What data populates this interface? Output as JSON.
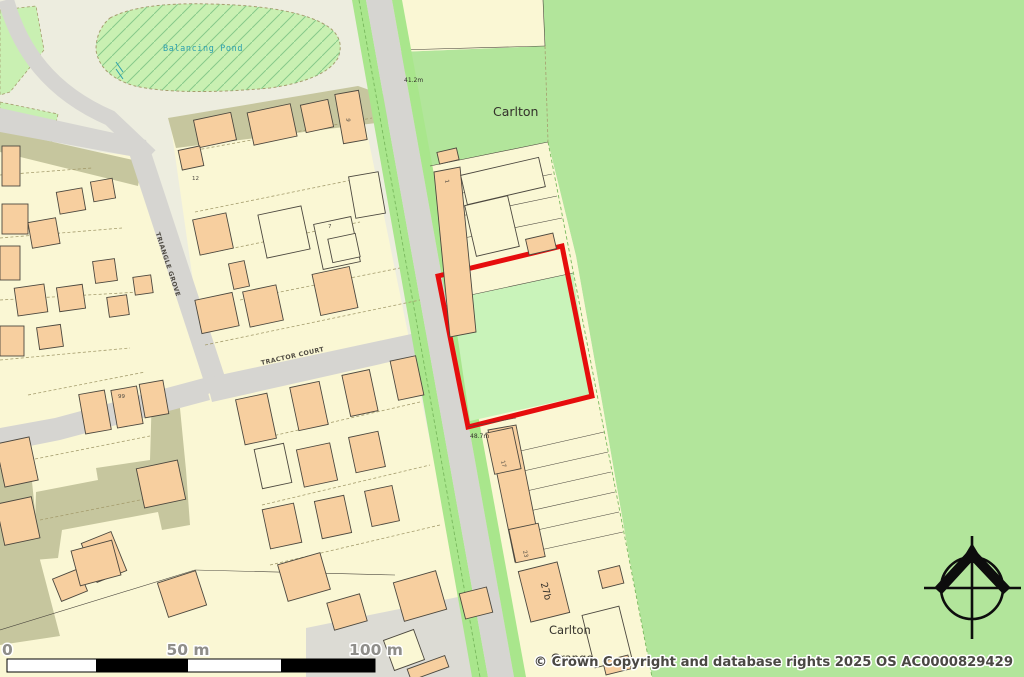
{
  "palette": {
    "bg": "#ededdf",
    "parcel": "#faf7d4",
    "building": "#f7cf9f",
    "building_line": "#4c483f",
    "field": "#b2e59b",
    "pond": "#c9f0b2",
    "verge": "#a9e68c",
    "verge_line": "#79b95e",
    "road": "#d6d5d1",
    "khaki": "#c6c69e",
    "parking": "#dcdbd4",
    "site_green": "#c9f3ba",
    "site_red": "#e60d0d",
    "dash": "#a59d6e",
    "text_dark": "#33312b",
    "pond_text": "#2b9fae",
    "street_text": "#4f4b43",
    "scale_text": "#8f8e8a",
    "copyright_text": "#4a4843",
    "compass": "#0d0d0d"
  },
  "labels": {
    "pond": "Balancing Pond",
    "area_carlton": "Carlton",
    "grange_line1": "Carlton",
    "grange_line2": "Grange",
    "street_triangle_grove": "TRIANGLE GROVE",
    "street_tractor_court": "TRACTOR COURT",
    "spot_height_north": "41.2m",
    "spot_height_mid": "48.7m",
    "house_27b": "27b",
    "house_numbers": [
      "6",
      "12",
      "7",
      "1",
      "99",
      "17",
      "23"
    ]
  },
  "scale_bar": {
    "tick_zero": "0",
    "tick_mid": "50 m",
    "tick_end": "100 m"
  },
  "copyright": "© Crown Copyright and database rights 2025 OS AC0000829429"
}
